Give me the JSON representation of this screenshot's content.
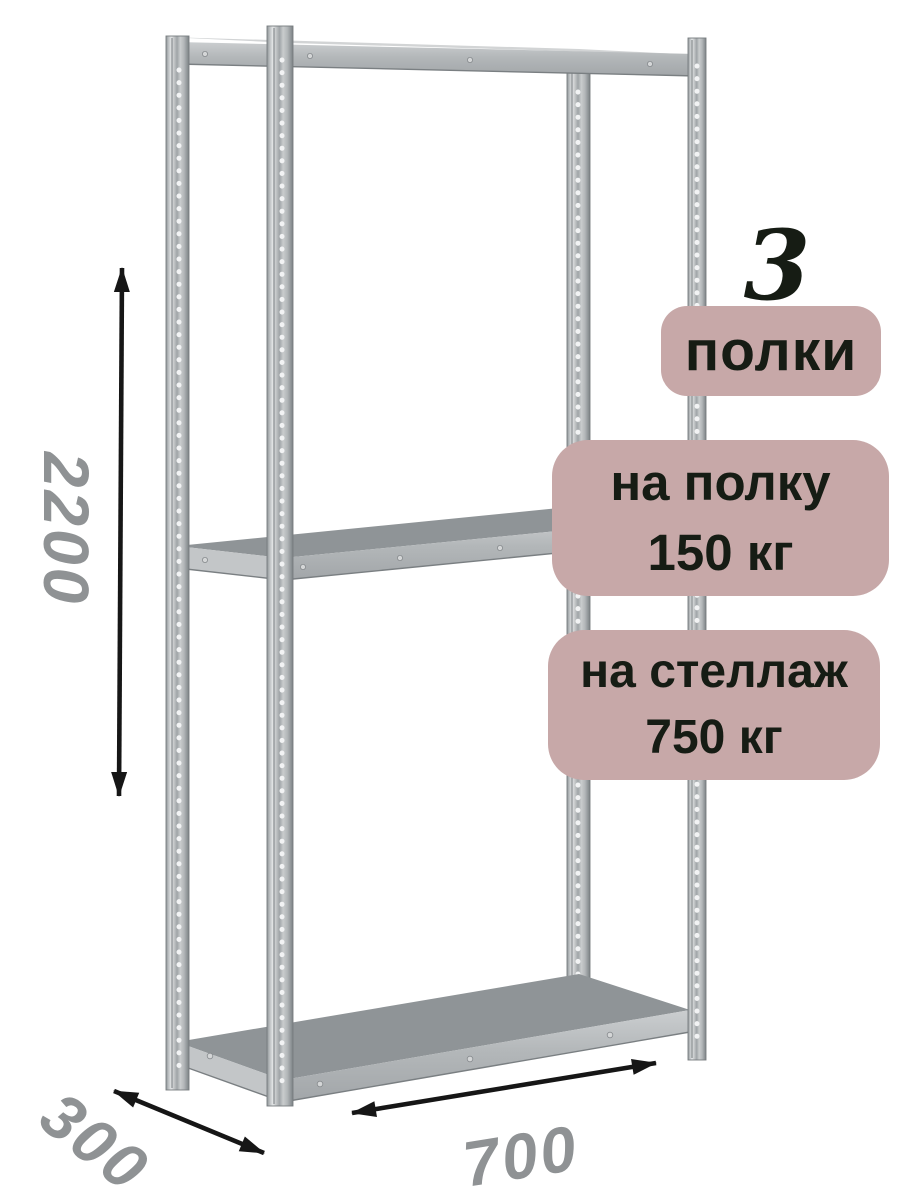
{
  "image": {
    "illustration_name": "metal-shelving-rack-3-shelves",
    "badges": {
      "shelf_count": {
        "number": "3",
        "label": "полки"
      },
      "shelf_load": {
        "line1": "на полку",
        "line2": "150 кг"
      },
      "rack_load": {
        "line1": "на стеллаж",
        "line2": "750 кг"
      }
    },
    "dimensions": {
      "height": "2200",
      "depth": "300",
      "width": "700"
    },
    "colors": {
      "bg": "#ffffff",
      "badge_bg": "#c7a8a8",
      "badge_text": "#161c14",
      "dimension_text": "#8f9294",
      "arrow": "#161616",
      "shelf_top": "#8f9497",
      "shelf_side": "#c3c6c8",
      "edge_line": "#7a7f82"
    }
  }
}
